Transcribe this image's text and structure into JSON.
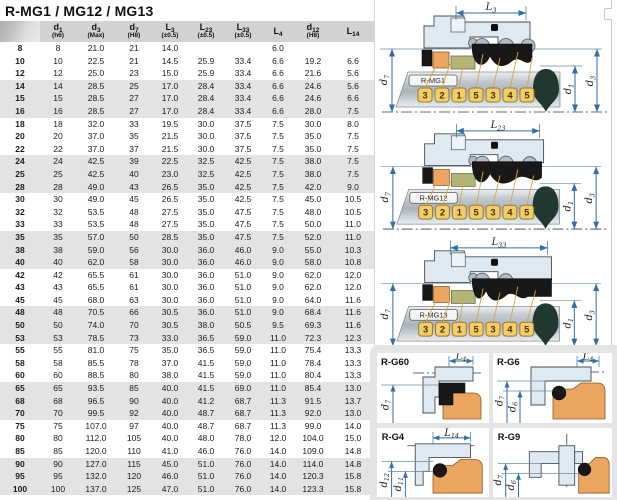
{
  "title": "R-MG1 / MG12 / MG13",
  "table": {
    "columns": [
      {
        "letter": "",
        "sub": "",
        "tol": ""
      },
      {
        "letter": "d",
        "sub": "1",
        "tol": "(h6)"
      },
      {
        "letter": "d",
        "sub": "3",
        "tol": "(Max)"
      },
      {
        "letter": "d",
        "sub": "7",
        "tol": "(H8)"
      },
      {
        "letter": "L",
        "sub": "3",
        "tol": "(±0.5)"
      },
      {
        "letter": "L",
        "sub": "23",
        "tol": "(±0.5)"
      },
      {
        "letter": "L",
        "sub": "33",
        "tol": "(±0.5)"
      },
      {
        "letter": "L",
        "sub": "4",
        "tol": ""
      },
      {
        "letter": "d",
        "sub": "12",
        "tol": "(H8)"
      },
      {
        "letter": "L",
        "sub": "14",
        "tol": ""
      }
    ],
    "rows": [
      [
        "8",
        "8",
        "21.0",
        "21",
        "14.0",
        "",
        "",
        "6.0",
        "",
        ""
      ],
      [
        "10",
        "10",
        "22.5",
        "21",
        "14.5",
        "25.9",
        "33.4",
        "6.6",
        "19.2",
        "6.6"
      ],
      [
        "12",
        "12",
        "25.0",
        "23",
        "15.0",
        "25.9",
        "33.4",
        "6.6",
        "21.6",
        "5.6"
      ],
      [
        "14",
        "14",
        "28.5",
        "25",
        "17.0",
        "28.4",
        "33.4",
        "6.6",
        "24.6",
        "5.6"
      ],
      [
        "15",
        "15",
        "28.5",
        "27",
        "17.0",
        "28.4",
        "33.4",
        "6.6",
        "24.6",
        "6.6"
      ],
      [
        "16",
        "16",
        "28.5",
        "27",
        "17.0",
        "28.4",
        "33.4",
        "6.6",
        "28.0",
        "7.5"
      ],
      [
        "18",
        "18",
        "32.0",
        "33",
        "19.5",
        "30.0",
        "37.5",
        "7.5",
        "30.0",
        "8.0"
      ],
      [
        "20",
        "20",
        "37.0",
        "35",
        "21.5",
        "30.0",
        "37.5",
        "7.5",
        "35.0",
        "7.5"
      ],
      [
        "22",
        "22",
        "37.0",
        "37",
        "21.5",
        "30.0",
        "37.5",
        "7.5",
        "35.0",
        "7.5"
      ],
      [
        "24",
        "24",
        "42.5",
        "39",
        "22.5",
        "32.5",
        "42.5",
        "7.5",
        "38.0",
        "7.5"
      ],
      [
        "25",
        "25",
        "42.5",
        "40",
        "23.0",
        "32.5",
        "42.5",
        "7.5",
        "38.0",
        "7.5"
      ],
      [
        "28",
        "28",
        "49.0",
        "43",
        "26.5",
        "35.0",
        "42.5",
        "7.5",
        "42.0",
        "9.0"
      ],
      [
        "30",
        "30",
        "49.0",
        "45",
        "26.5",
        "35.0",
        "42.5",
        "7.5",
        "45.0",
        "10.5"
      ],
      [
        "32",
        "32",
        "53.5",
        "48",
        "27.5",
        "35.0",
        "47.5",
        "7.5",
        "48.0",
        "10.5"
      ],
      [
        "33",
        "33",
        "53.5",
        "48",
        "27.5",
        "35.0",
        "47.5",
        "7.5",
        "50.0",
        "11.0"
      ],
      [
        "35",
        "35",
        "57.0",
        "50",
        "28.5",
        "35.0",
        "47.5",
        "7.5",
        "52.0",
        "11.0"
      ],
      [
        "38",
        "38",
        "59.0",
        "56",
        "30.0",
        "36.0",
        "46.0",
        "9.0",
        "55.0",
        "10.3"
      ],
      [
        "40",
        "40",
        "62.0",
        "58",
        "30.0",
        "36.0",
        "46.0",
        "9.0",
        "58.0",
        "10.8"
      ],
      [
        "42",
        "42",
        "65.5",
        "61",
        "30.0",
        "36.0",
        "51.0",
        "9.0",
        "62.0",
        "12.0"
      ],
      [
        "43",
        "43",
        "65.5",
        "61",
        "30.0",
        "36.0",
        "51.0",
        "9.0",
        "62.0",
        "12.0"
      ],
      [
        "45",
        "45",
        "68.0",
        "63",
        "30.0",
        "36.0",
        "51.0",
        "9.0",
        "64.0",
        "11.6"
      ],
      [
        "48",
        "48",
        "70.5",
        "66",
        "30.5",
        "36.0",
        "51.0",
        "9.0",
        "68.4",
        "11.6"
      ],
      [
        "50",
        "50",
        "74.0",
        "70",
        "30.5",
        "38.0",
        "50.5",
        "9.5",
        "69.3",
        "11.6"
      ],
      [
        "53",
        "53",
        "78.5",
        "73",
        "33.0",
        "36.5",
        "59.0",
        "11.0",
        "72.3",
        "12.3"
      ],
      [
        "55",
        "55",
        "81.0",
        "75",
        "35.0",
        "36.5",
        "59.0",
        "11.0",
        "75.4",
        "13.3"
      ],
      [
        "58",
        "58",
        "85.5",
        "78",
        "37.0",
        "41.5",
        "59.0",
        "11.0",
        "78.4",
        "13.3"
      ],
      [
        "60",
        "60",
        "88.5",
        "80",
        "38.0",
        "41.5",
        "59.0",
        "11.0",
        "80.4",
        "13.3"
      ],
      [
        "65",
        "65",
        "93.5",
        "85",
        "40.0",
        "41.5",
        "69.0",
        "11.0",
        "85.4",
        "13.0"
      ],
      [
        "68",
        "68",
        "96.5",
        "90",
        "40.0",
        "41.2",
        "68.7",
        "11.3",
        "91.5",
        "13.7"
      ],
      [
        "70",
        "70",
        "99.5",
        "92",
        "40.0",
        "48.7",
        "68.7",
        "11.3",
        "92.0",
        "13.0"
      ],
      [
        "75",
        "75",
        "107.0",
        "97",
        "40.0",
        "48.7",
        "68.7",
        "11.3",
        "99.0",
        "14.0"
      ],
      [
        "80",
        "80",
        "112.0",
        "105",
        "40.0",
        "48.0",
        "78.0",
        "12.0",
        "104.0",
        "15.0"
      ],
      [
        "85",
        "85",
        "120.0",
        "110",
        "41.0",
        "46.0",
        "76.0",
        "14.0",
        "109.0",
        "14.8"
      ],
      [
        "90",
        "90",
        "127.0",
        "115",
        "45.0",
        "51.0",
        "76.0",
        "14.0",
        "114.0",
        "14.8"
      ],
      [
        "95",
        "95",
        "132.0",
        "120",
        "46.0",
        "51.0",
        "76.0",
        "14.0",
        "120.3",
        "15.8"
      ],
      [
        "100",
        "100",
        "137.0",
        "125",
        "47.0",
        "51.0",
        "76.0",
        "14.0",
        "123.3",
        "15.8"
      ]
    ]
  },
  "mg_diagrams": [
    {
      "label": "R-MG1",
      "dim": {
        "letter": "L",
        "sub": "3"
      },
      "left_dim": {
        "letter": "d",
        "sub": "7"
      },
      "right_dims": [
        {
          "letter": "d",
          "sub": "1"
        },
        {
          "letter": "d",
          "sub": "3"
        }
      ],
      "tags": [
        "3",
        "2",
        "1",
        "5",
        "3",
        "4",
        "5"
      ]
    },
    {
      "label": "R-MG12",
      "dim": {
        "letter": "L",
        "sub": "23"
      },
      "left_dim": {
        "letter": "d",
        "sub": "7"
      },
      "right_dims": [
        {
          "letter": "d",
          "sub": "1"
        },
        {
          "letter": "d",
          "sub": "3"
        }
      ],
      "tags": [
        "3",
        "2",
        "1",
        "5",
        "3",
        "4",
        "5"
      ]
    },
    {
      "label": "R-MG13",
      "dim": {
        "letter": "L",
        "sub": "33"
      },
      "left_dim": {
        "letter": "d",
        "sub": "7"
      },
      "right_dims": [
        {
          "letter": "d",
          "sub": "1"
        },
        {
          "letter": "d",
          "sub": "3"
        }
      ],
      "tags": [
        "3",
        "2",
        "1",
        "5",
        "3",
        "4",
        "5"
      ]
    }
  ],
  "seat_diagrams": [
    {
      "label": "R-G60",
      "top_dim": {
        "letter": "L",
        "sub": "4"
      },
      "left_dims": [
        {
          "letter": "d",
          "sub": "7"
        }
      ]
    },
    {
      "label": "R-G6",
      "top_dim": {
        "letter": "L",
        "sub": "4"
      },
      "left_dims": [
        {
          "letter": "d",
          "sub": "7"
        },
        {
          "letter": "d",
          "sub": "6"
        }
      ]
    },
    {
      "label": "R-G4",
      "top_dim": {
        "letter": "L",
        "sub": "14"
      },
      "left_dims": [
        {
          "letter": "d",
          "sub": "12"
        },
        {
          "letter": "d",
          "sub": "11"
        }
      ]
    },
    {
      "label": "R-G9",
      "left_dims": [
        {
          "letter": "d",
          "sub": "7"
        },
        {
          "letter": "d",
          "sub": "6"
        }
      ]
    }
  ],
  "colors": {
    "dimension_blue": "#2f6ea8",
    "tag_yellow": "#f3cd69",
    "seal_orange": "#eba55e",
    "seal_olive": "#b3b478",
    "housing_blue": "#dfe9f1",
    "header_gray": "#d2d2d2",
    "band_gray": "#e3e3e3",
    "drop_dark": "#203830"
  }
}
